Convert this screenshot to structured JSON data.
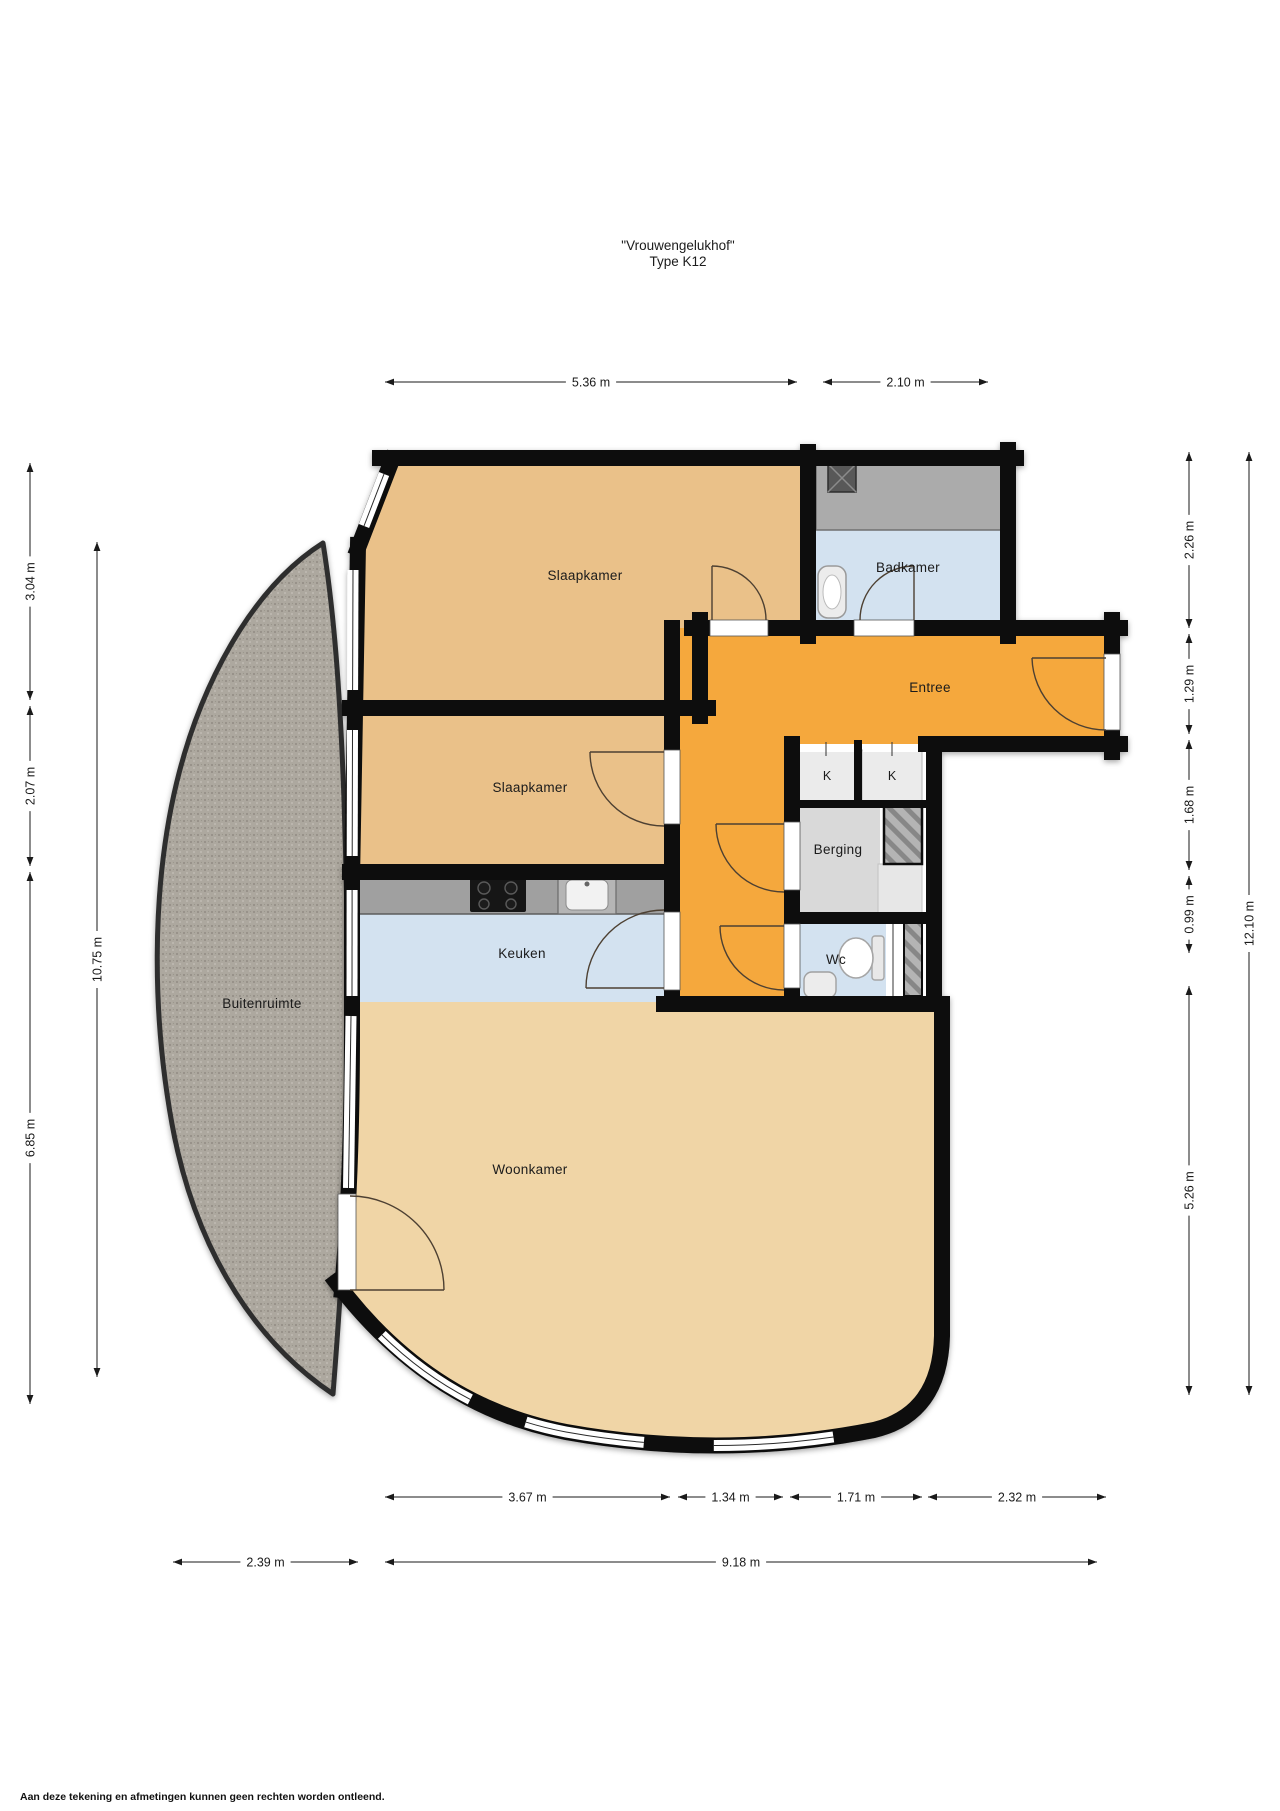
{
  "title": {
    "line1": "\"Vrouwengelukhof\"",
    "line2": "Type K12"
  },
  "rooms": {
    "slaapkamer1": "Slaapkamer",
    "slaapkamer2": "Slaapkamer",
    "badkamer": "Badkamer",
    "entree": "Entree",
    "berging": "Berging",
    "keuken": "Keuken",
    "wc": "Wc",
    "woonkamer": "Woonkamer",
    "buitenruimte": "Buitenruimte",
    "kast1": "K",
    "kast2": "K"
  },
  "dims": {
    "top1": "5.36 m",
    "top2": "2.10 m",
    "left1": "3.04 m",
    "left2": "2.07 m",
    "left3": "6.85 m",
    "left_total": "10.75 m",
    "right1": "2.26 m",
    "right2": "1.29 m",
    "right3": "1.68 m",
    "right4": "0.99 m",
    "right5": "5.26 m",
    "right_total": "12.10 m",
    "bottom1": "3.67 m",
    "bottom2": "1.34 m",
    "bottom3": "1.71 m",
    "bottom4": "2.32 m",
    "bottom_balcony": "2.39 m",
    "bottom_total": "9.18 m"
  },
  "footer": {
    "disclaimer": "Aan deze tekening en afmetingen kunnen geen rechten worden ontleend."
  },
  "colors": {
    "room_tan": "#eac189",
    "room_tan_light": "#f0d5a6",
    "wet_blue": "#d3e2f0",
    "hall_orange": "#f5a83d",
    "storage_gray": "#d9d9d9",
    "counter_gray": "#a0a0a0",
    "outdoor_gray": "#ada89f",
    "wall_black": "#0b0b0b"
  }
}
